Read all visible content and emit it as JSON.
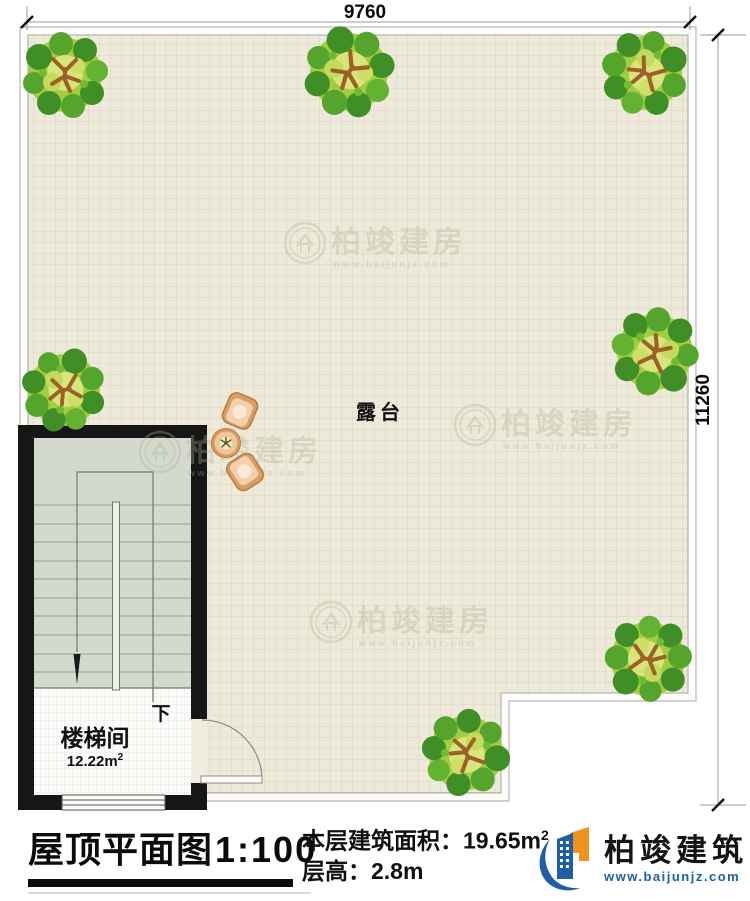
{
  "dimensions": {
    "top_width": "9760",
    "right_height": "11260"
  },
  "plan": {
    "terrace_label": "露台",
    "down_label": "下",
    "stair_room": {
      "label": "楼梯间",
      "area": "12.22m",
      "area_sup": "2"
    }
  },
  "watermark": {
    "brand": "柏竣建房",
    "url": "www.baijunjz.com"
  },
  "legend": {
    "title": "屋顶平面图",
    "scale": "1:100",
    "area_label": "本层建筑面积：19.65m",
    "area_sup": "2",
    "floor_height": "层高：2.8m"
  },
  "logo": {
    "brand": "柏竣建筑",
    "url": "www.baijunjz.com"
  },
  "colors": {
    "brand_blue": "#1e5fa8",
    "brand_orange": "#f0921e",
    "url_blue": "#1e5fa8"
  }
}
